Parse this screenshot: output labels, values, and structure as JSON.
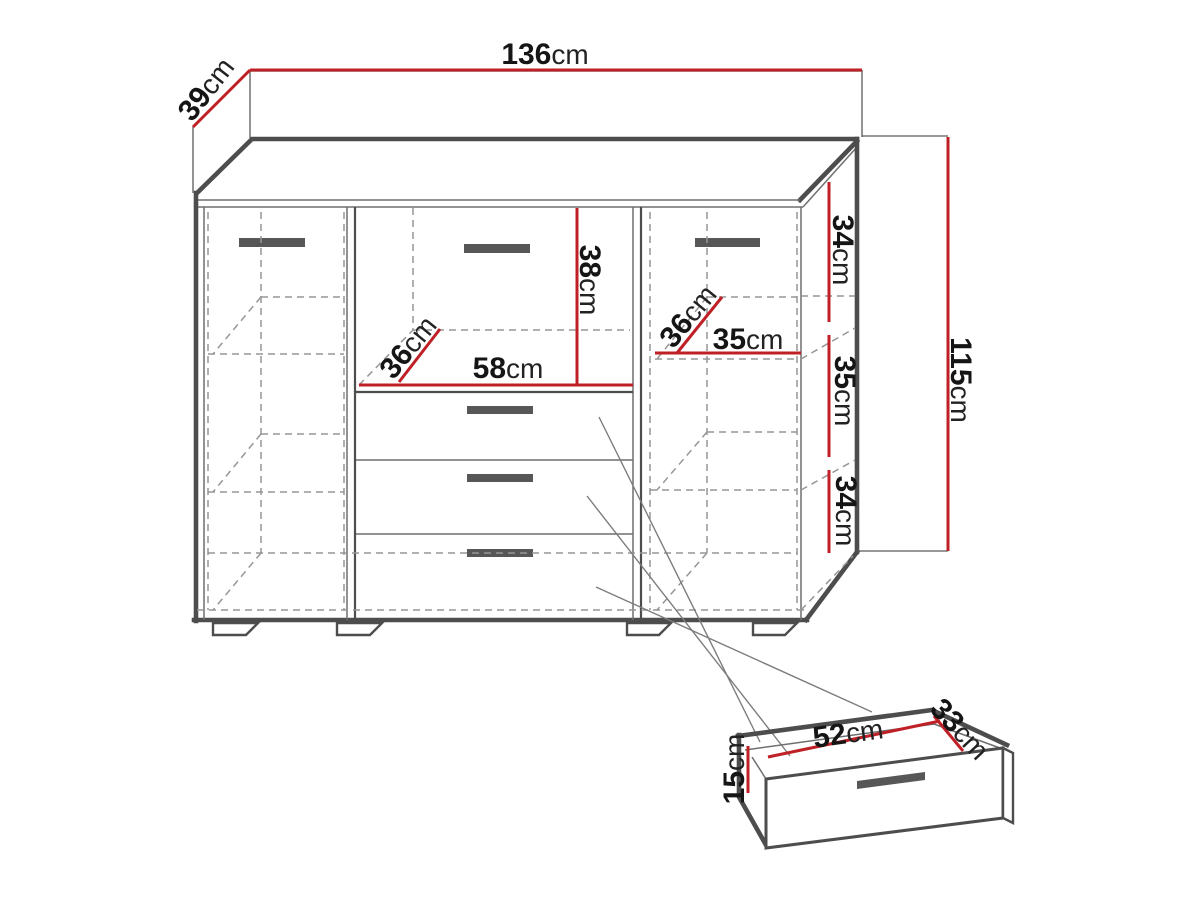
{
  "colors": {
    "dimension_red": "#bf2026",
    "outline_gray": "#4d4d4d",
    "hidden_gray": "#969696",
    "handle_gray": "#575757"
  },
  "dimensions": {
    "top_width": {
      "value": "136",
      "unit": "cm"
    },
    "top_depth": {
      "value": "39",
      "unit": "cm"
    },
    "total_height": {
      "value": "115",
      "unit": "cm"
    },
    "right_top": {
      "value": "34",
      "unit": "cm"
    },
    "right_mid": {
      "value": "35",
      "unit": "cm"
    },
    "right_bottom": {
      "value": "34",
      "unit": "cm"
    },
    "niche_height": {
      "value": "38",
      "unit": "cm"
    },
    "niche_width": {
      "value": "58",
      "unit": "cm"
    },
    "niche_depth": {
      "value": "36",
      "unit": "cm"
    },
    "shelf_depth": {
      "value": "36",
      "unit": "cm"
    },
    "shelf_width": {
      "value": "35",
      "unit": "cm"
    },
    "drawer_inner_width": {
      "value": "52",
      "unit": "cm"
    },
    "drawer_inner_depth": {
      "value": "33",
      "unit": "cm"
    },
    "drawer_front_height": {
      "value": "15",
      "unit": "cm"
    }
  }
}
